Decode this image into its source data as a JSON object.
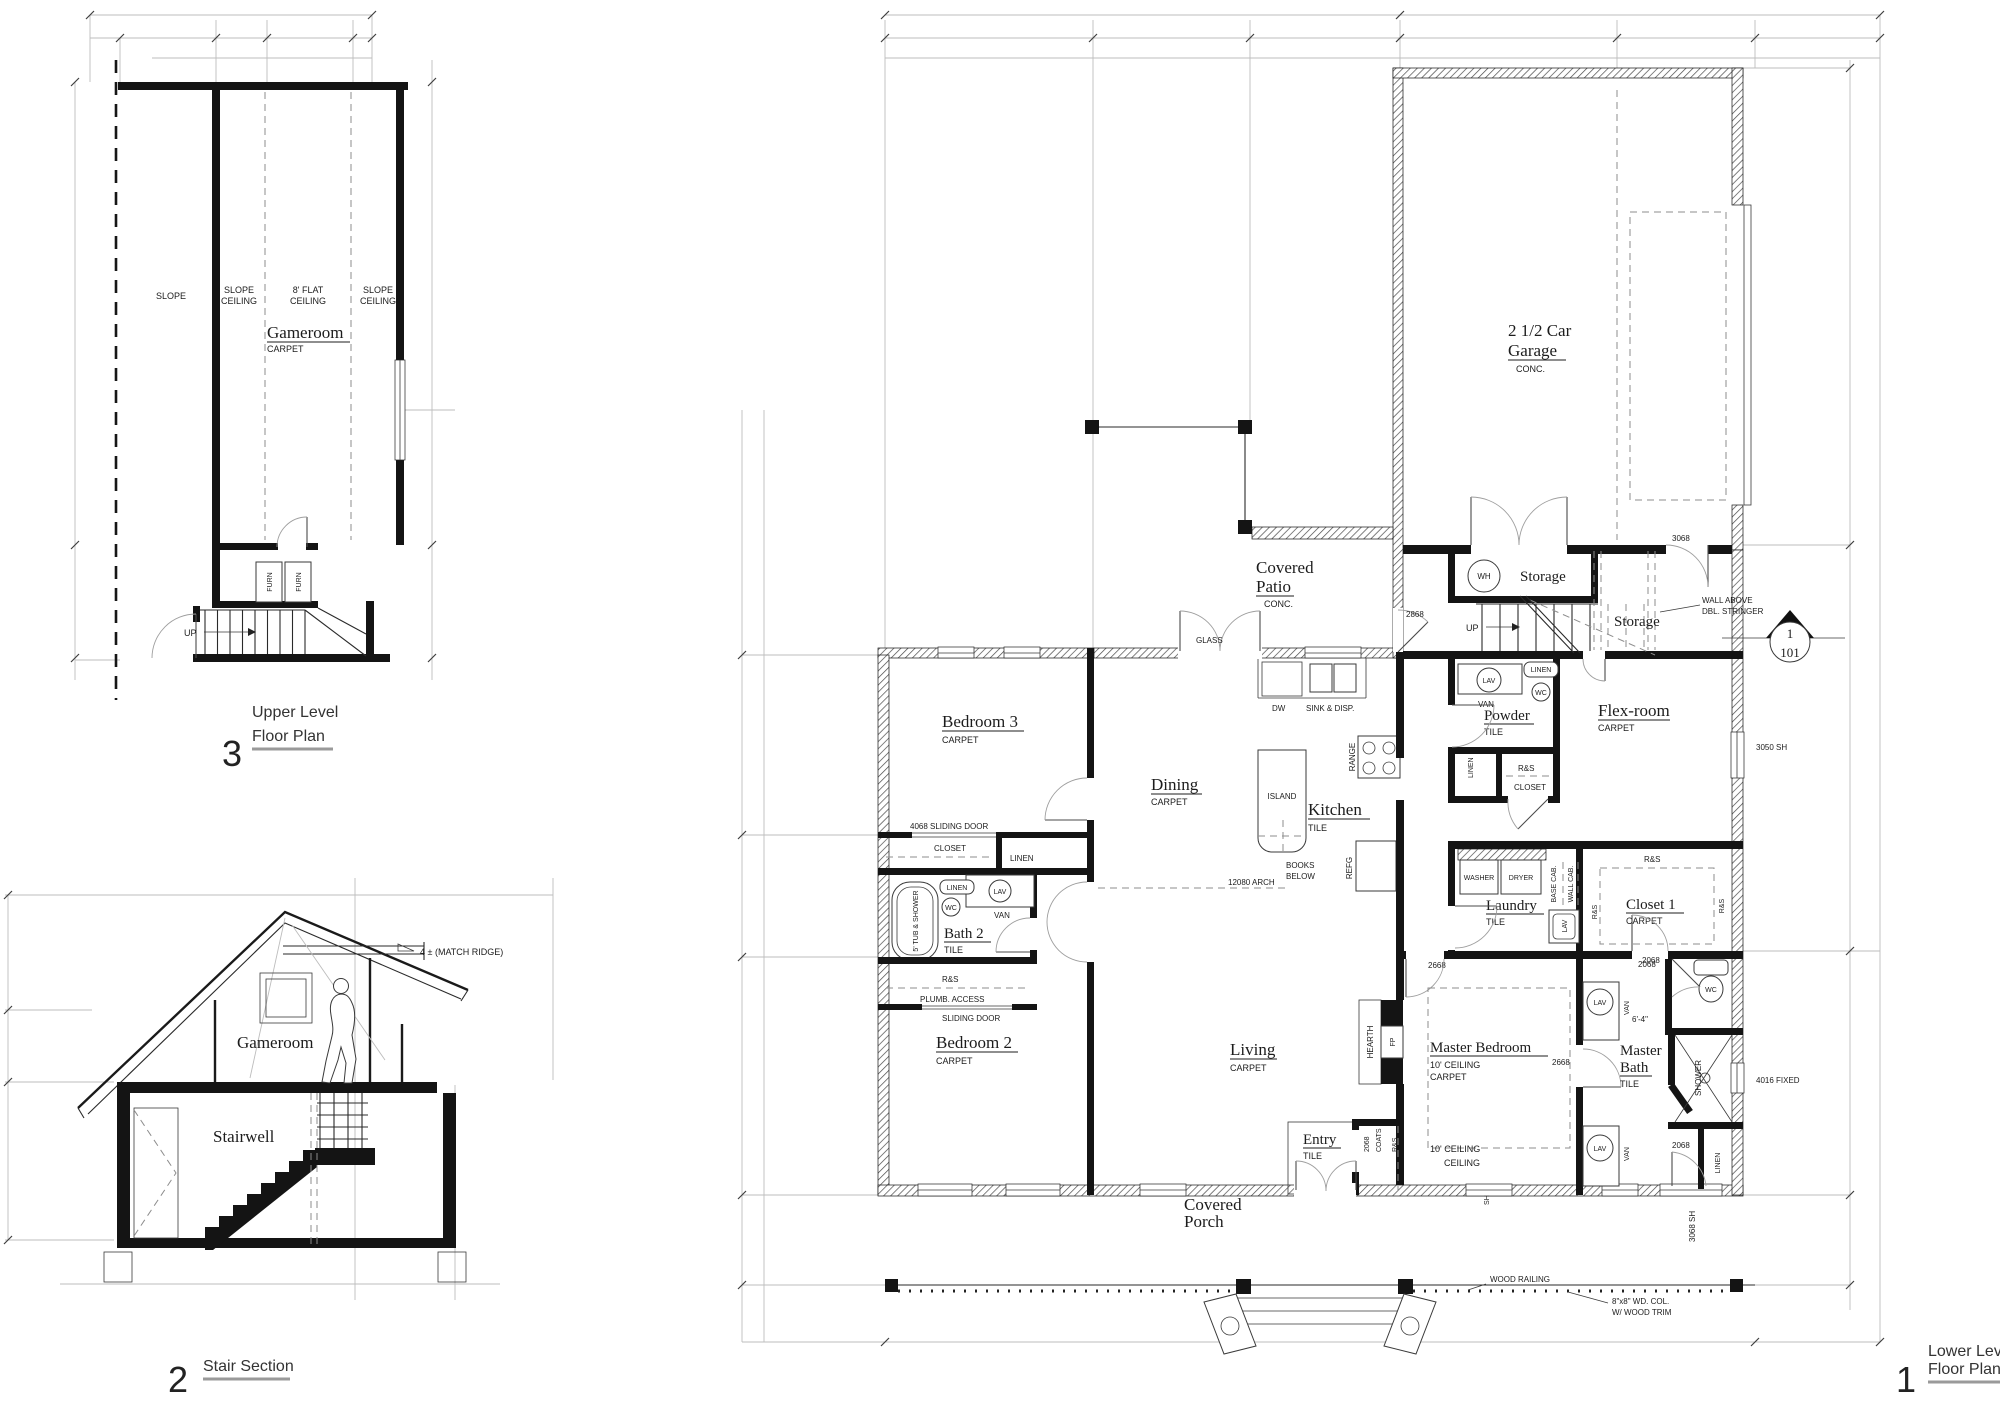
{
  "up": {
    "num": "3",
    "t1": "Upper Level",
    "t2": "Floor Plan",
    "slope": "SLOPE",
    "sc1": "SLOPE",
    "sc2": "CEILING",
    "fc1": "8' FLAT",
    "fc2": "CEILING",
    "room": "Gameroom",
    "carpet": "CARPET",
    "furn": "FURN",
    "dir": "UP"
  },
  "sec": {
    "num": "2",
    "t": "Stair Section",
    "ridge": "4 ± (MATCH RIDGE)",
    "room": "Gameroom",
    "well": "Stairwell"
  },
  "lp": {
    "num": "1",
    "t1": "Lower Level",
    "t2": "Floor Plan",
    "garage1": "2 1/2 Car",
    "garage2": "Garage",
    "conc": "CONC.",
    "patio1": "Covered",
    "patio2": "Patio",
    "porch1": "Covered",
    "porch2": "Porch",
    "storage": "Storage",
    "wh": "WH",
    "dir": "UP",
    "wa1": "WALL ABOVE",
    "wa2": "DBL. STRINGER",
    "mk1": "1",
    "mk2": "101",
    "bed3": "Bedroom 3",
    "bed2": "Bedroom 2",
    "dining": "Dining",
    "kitchen": "Kitchen",
    "living": "Living",
    "entry": "Entry",
    "powder": "Powder",
    "flex": "Flex-room",
    "laundry": "Laundry",
    "closet1": "Closet 1",
    "mbed": "Master Bedroom",
    "mbath1": "Master",
    "mbath2": "Bath",
    "bath2": "Bath 2",
    "carpet": "CARPET",
    "tile": "TILE",
    "dw": "DW",
    "sink": "SINK & DISP.",
    "range": "RANGE",
    "island": "ISLAND",
    "books1": "BOOKS",
    "books2": "BELOW",
    "refg": "REFG",
    "arch": "12080 ARCH",
    "glass": "GLASS",
    "lav": "LAV",
    "wc": "WC",
    "van": "VAN",
    "linen": "LINEN",
    "rs": "R&S",
    "closet": "CLOSET",
    "washer": "WASHER",
    "dryer": "DRYER",
    "bcab": "BASE CAB.",
    "wcab": "WALL CAB.",
    "tub": "5' TUB & SHOWER",
    "shower": "SHOWER",
    "hearth": "HEARTH",
    "fp": "FP",
    "coats": "COATS",
    "plumb": "PLUMB. ACCESS",
    "sdoor": "SLIDING DOOR",
    "d2068": "2068",
    "d2668": "2668",
    "d2868": "2868",
    "d3068": "3068",
    "d4068": "4068 SLIDING DOOR",
    "w3050": "3050 SH",
    "w4016": "4016 FIXED",
    "w3068": "3068 SH",
    "sh": "SH",
    "dim64": "6'-4\"",
    "c10": "10' CEILING",
    "ceil": "CEILING",
    "rail": "WOOD RAILING",
    "col1": "8\"x8\" WD. COL.",
    "col2": "W/ WOOD TRIM"
  }
}
